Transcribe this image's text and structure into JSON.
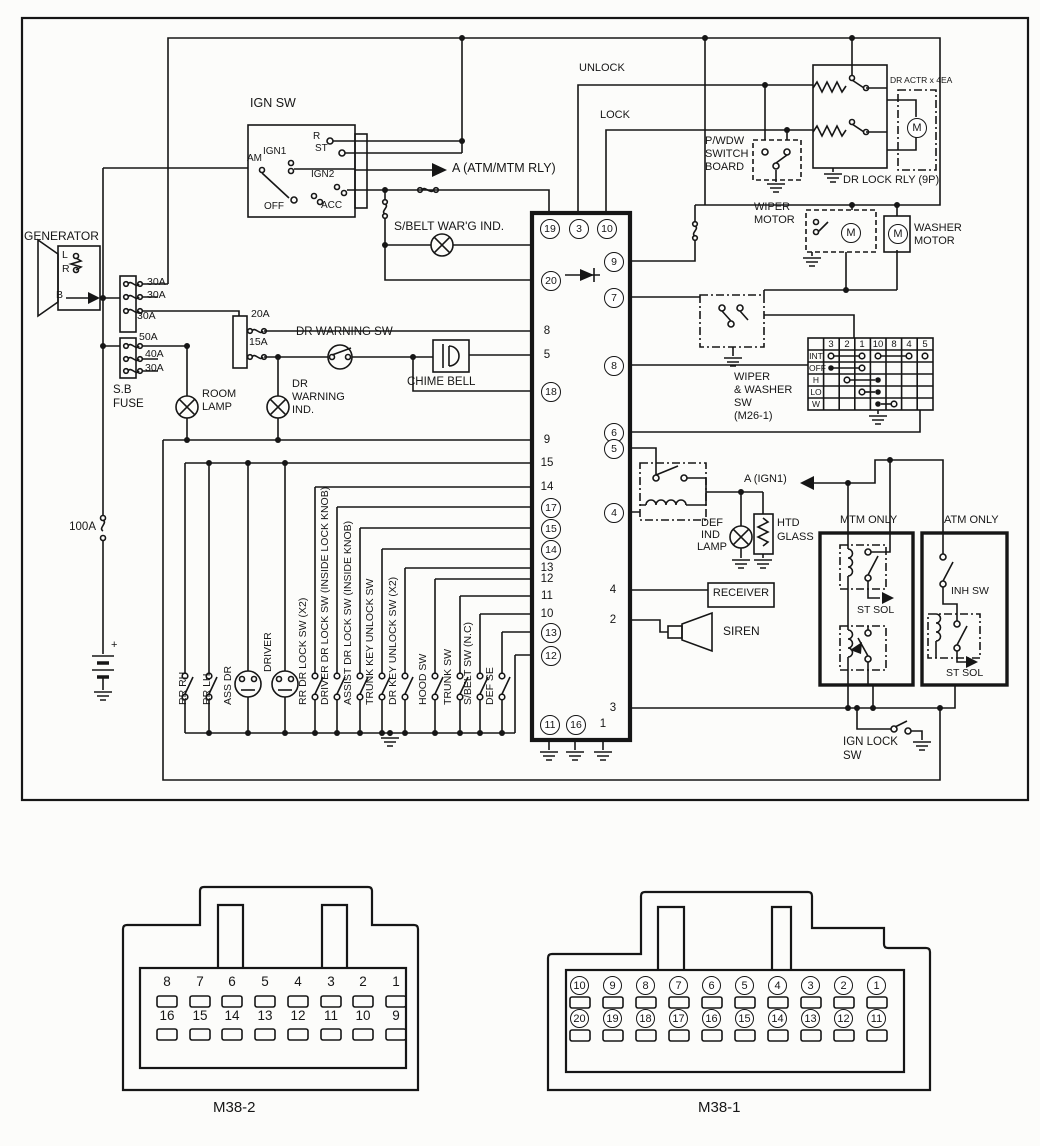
{
  "ign_sw": {
    "title": "IGN SW",
    "am": "AM",
    "off": "OFF",
    "r": "R",
    "st": "ST",
    "ign1": "IGN1",
    "ign2": "IGN2",
    "acc": "ACC"
  },
  "arrows": {
    "atm_mtm": "A (ATM/MTM RLY)",
    "a_ign1": "A (IGN1)"
  },
  "generator": {
    "title": "GENERATOR",
    "term_l": "L",
    "term_r": "R",
    "term_b": "B"
  },
  "fuse_block": {
    "f1": "30A",
    "f2": "30A",
    "f3": "30A",
    "f4": "50A",
    "f5": "40A",
    "f6": "30A",
    "name1": "S.B",
    "name2": "FUSE",
    "f20": "20A",
    "f15": "15A",
    "f100": "100A"
  },
  "battery": {
    "plus": "+"
  },
  "lamps": {
    "sbelt": "S/BELT WAR'G IND.",
    "room1": "ROOM",
    "room2": "LAMP",
    "drw1": "DR",
    "drw2": "WARNING",
    "drw3": "IND.",
    "def1": "DEF",
    "def2": "IND",
    "def3": "LAMP"
  },
  "switches": {
    "dr_warning": "DR WARNING SW",
    "chime": "CHIME BELL",
    "ign_lock1": "IGN LOCK",
    "ign_lock2": "SW",
    "inh": "INH SW"
  },
  "door_lock": {
    "unlock": "UNLOCK",
    "lock": "LOCK",
    "pwdw1": "P/WDW",
    "pwdw2": "SWITCH",
    "pwdw3": "BOARD",
    "actr": "DR ACTR x 4EA",
    "relay": "DR LOCK RLY (9P)"
  },
  "wiper": {
    "motor1": "WIPER",
    "motor2": "MOTOR",
    "washer1": "WASHER",
    "washer2": "MOTOR",
    "sw1": "WIPER",
    "sw2": "& WASHER",
    "sw3": "SW",
    "sw4": "(M26-1)",
    "cols": [
      "3",
      "2",
      "1",
      "10",
      "8",
      "4",
      "5"
    ],
    "rows": [
      "INT",
      "OFF",
      "H",
      "LO",
      "W"
    ]
  },
  "defog": {
    "htd1": "HTD",
    "htd2": "GLASS"
  },
  "theft": {
    "receiver": "RECEIVER",
    "siren": "SIREN"
  },
  "trans": {
    "mtm": "MTM ONLY",
    "atm": "ATM ONLY",
    "st_sol1": "ST SOL",
    "st_sol2": "ST SOL"
  },
  "motor_m": "M",
  "bank": [
    "RR RH",
    "RR LH",
    "ASS DR",
    "DRIVER",
    "RR DR LOCK SW (X2)",
    "DRIVER DR LOCK SW (INSIDE LOCK KNOB)",
    "ASSIST DR LOCK SW (INSIDE KNOB)",
    "TRUNK KEY UNLOCK SW",
    "DR KEY UNLOCK SW (X2)",
    "HOOD SW",
    "TRUNK SW",
    "S/BELT SW (N.C)",
    "DEF SE"
  ],
  "unit": {
    "top": [
      "19",
      "3",
      "10"
    ],
    "left": [
      "20",
      "8",
      "5",
      "18",
      "9",
      "15",
      "14",
      "17",
      "15",
      "14",
      "13",
      "12",
      "11",
      "10",
      "13",
      "12"
    ],
    "right": [
      "9",
      "7",
      "8",
      "6",
      "5",
      "4",
      "4",
      "2",
      "3",
      "1"
    ],
    "bottom": [
      "11",
      "16"
    ]
  },
  "conn": {
    "m2": "M38-2",
    "m2r1": [
      "8",
      "7",
      "6",
      "5",
      "4",
      "3",
      "2",
      "1"
    ],
    "m2r2": [
      "16",
      "15",
      "14",
      "13",
      "12",
      "11",
      "10",
      "9"
    ],
    "m1": "M38-1",
    "m1r1": [
      "10",
      "9",
      "8",
      "7",
      "6",
      "5",
      "4",
      "3",
      "2",
      "1"
    ],
    "m1r2": [
      "20",
      "19",
      "18",
      "17",
      "16",
      "15",
      "14",
      "13",
      "12",
      "11"
    ]
  }
}
